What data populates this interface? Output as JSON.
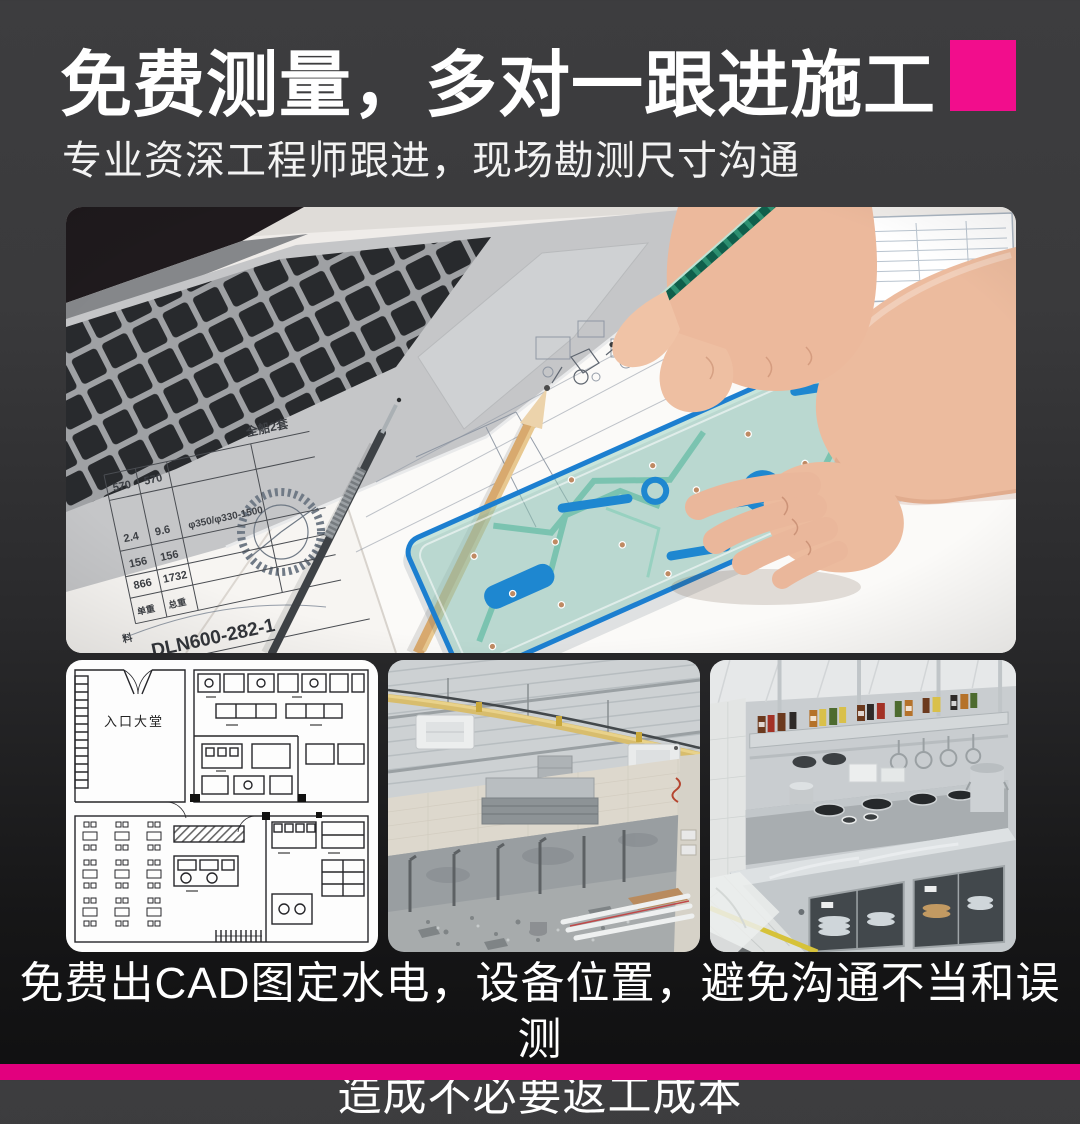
{
  "colors": {
    "background_top": "#3d3d3f",
    "background_bottom": "#101011",
    "accent_pink": "#f20d8c",
    "bar_pink": "#e2007e",
    "text_white": "#ffffff"
  },
  "header": {
    "title": "免费测量，多对一跟进施工",
    "subtitle": "专业资深工程师跟进，现场勘测尺寸沟通"
  },
  "hero": {
    "photo_name": "engineer-hands-drawing-blueprints-with-laptop-and-stencil",
    "paper_table": {
      "top_note": "全船2套",
      "rows": [
        "570",
        "570",
        "2.4",
        "9.6",
        "φ350/φ330-1500",
        "156",
        "156",
        "866",
        "1732",
        "单重",
        "总重"
      ],
      "col_label": "料",
      "part_no": "DLN600-282-1",
      "bottom_note": "6000M3把焊烟机",
      "side_label": "系统"
    }
  },
  "gallery": {
    "plan": {
      "photo_name": "cad-floor-plan",
      "hall_label": "入口大堂"
    },
    "site": {
      "photo_name": "kitchen-construction-site"
    },
    "kitchen": {
      "photo_name": "finished-commercial-kitchen"
    }
  },
  "footer": {
    "line1": "免费出CAD图定水电，设备位置，避免沟通不当和误测",
    "line2": "造成不必要返工成本"
  }
}
